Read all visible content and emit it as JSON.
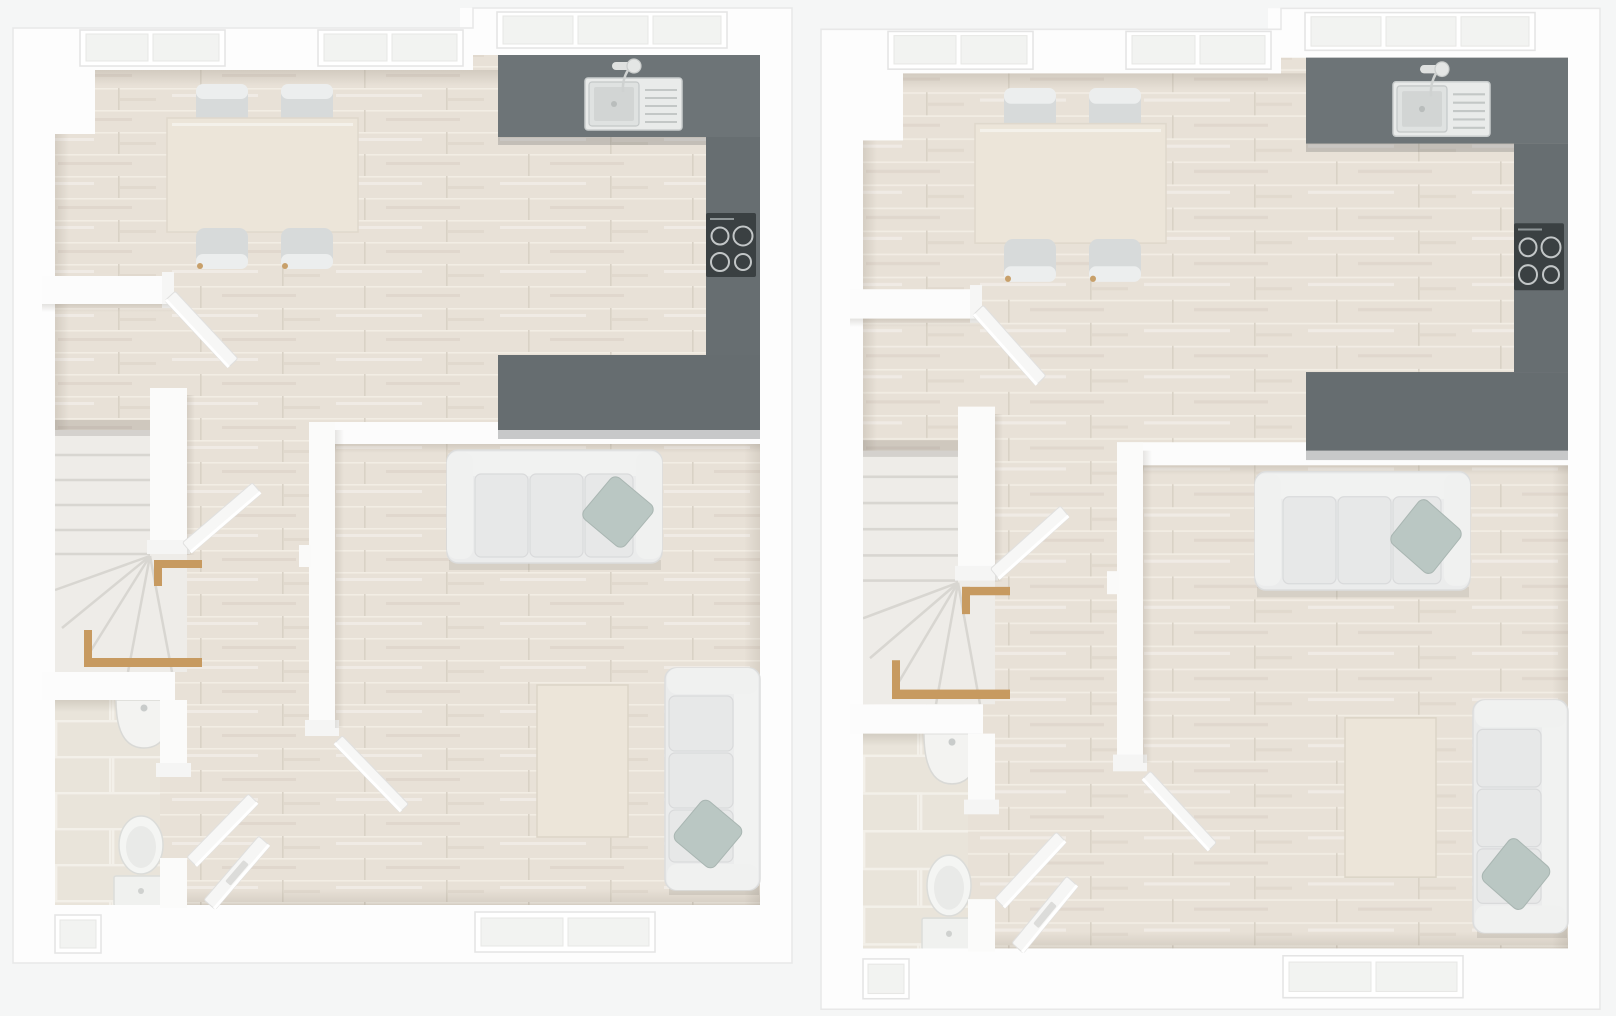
{
  "page": {
    "title": "Top-down 3D ground-floor plan render of two identical adjoining homes",
    "background": "#f5f6f6"
  },
  "units": [
    {
      "id": "left",
      "label": "Ground floor plan - left unit"
    },
    {
      "id": "right",
      "label": "Ground floor plan - right unit"
    }
  ],
  "plan": {
    "rooms": [
      {
        "name": "kitchen-dining-room",
        "features": [
          "dining table",
          "four chairs",
          "grey U-shaped worktop",
          "inset sink with drainer and tap",
          "four-ring hob",
          "two front windows",
          "window above sink"
        ]
      },
      {
        "name": "living-room",
        "features": [
          "three-seat sofa with accent cushion",
          "two-seat sofa with accent cushion",
          "wooden coffee table",
          "rear window"
        ]
      },
      {
        "name": "hallway",
        "features": [
          "front door with letterbox",
          "door to kitchen-diner",
          "door to living room",
          "winder staircase with timber handrails"
        ]
      },
      {
        "name": "wc",
        "features": [
          "toilet with cistern",
          "wall-hung half-round basin",
          "tiled floor",
          "rear window"
        ]
      }
    ],
    "palette": {
      "background": "#f5f6f6",
      "wall": "#fdfdfd",
      "wall_shade": "#ececec",
      "floor_wood": "#e8e1d7",
      "plank_line": "#d9d2c6",
      "counter": "#6d7477",
      "counter_side": "#676e71",
      "counter_bottom": "#666d70",
      "hob": "#3a4042",
      "hob_ring": "#c2c6c7",
      "sink": "#e9ebea",
      "table_wood": "#ece5d9",
      "chair": "#d7dada",
      "sofa": "#ebecec",
      "accent_pillow": "#bac7c3",
      "handrail": "#c79a60",
      "tile": "#e9e4da",
      "tile_grout": "#f3f0e9",
      "fixture_white": "#f3f3f1"
    }
  }
}
